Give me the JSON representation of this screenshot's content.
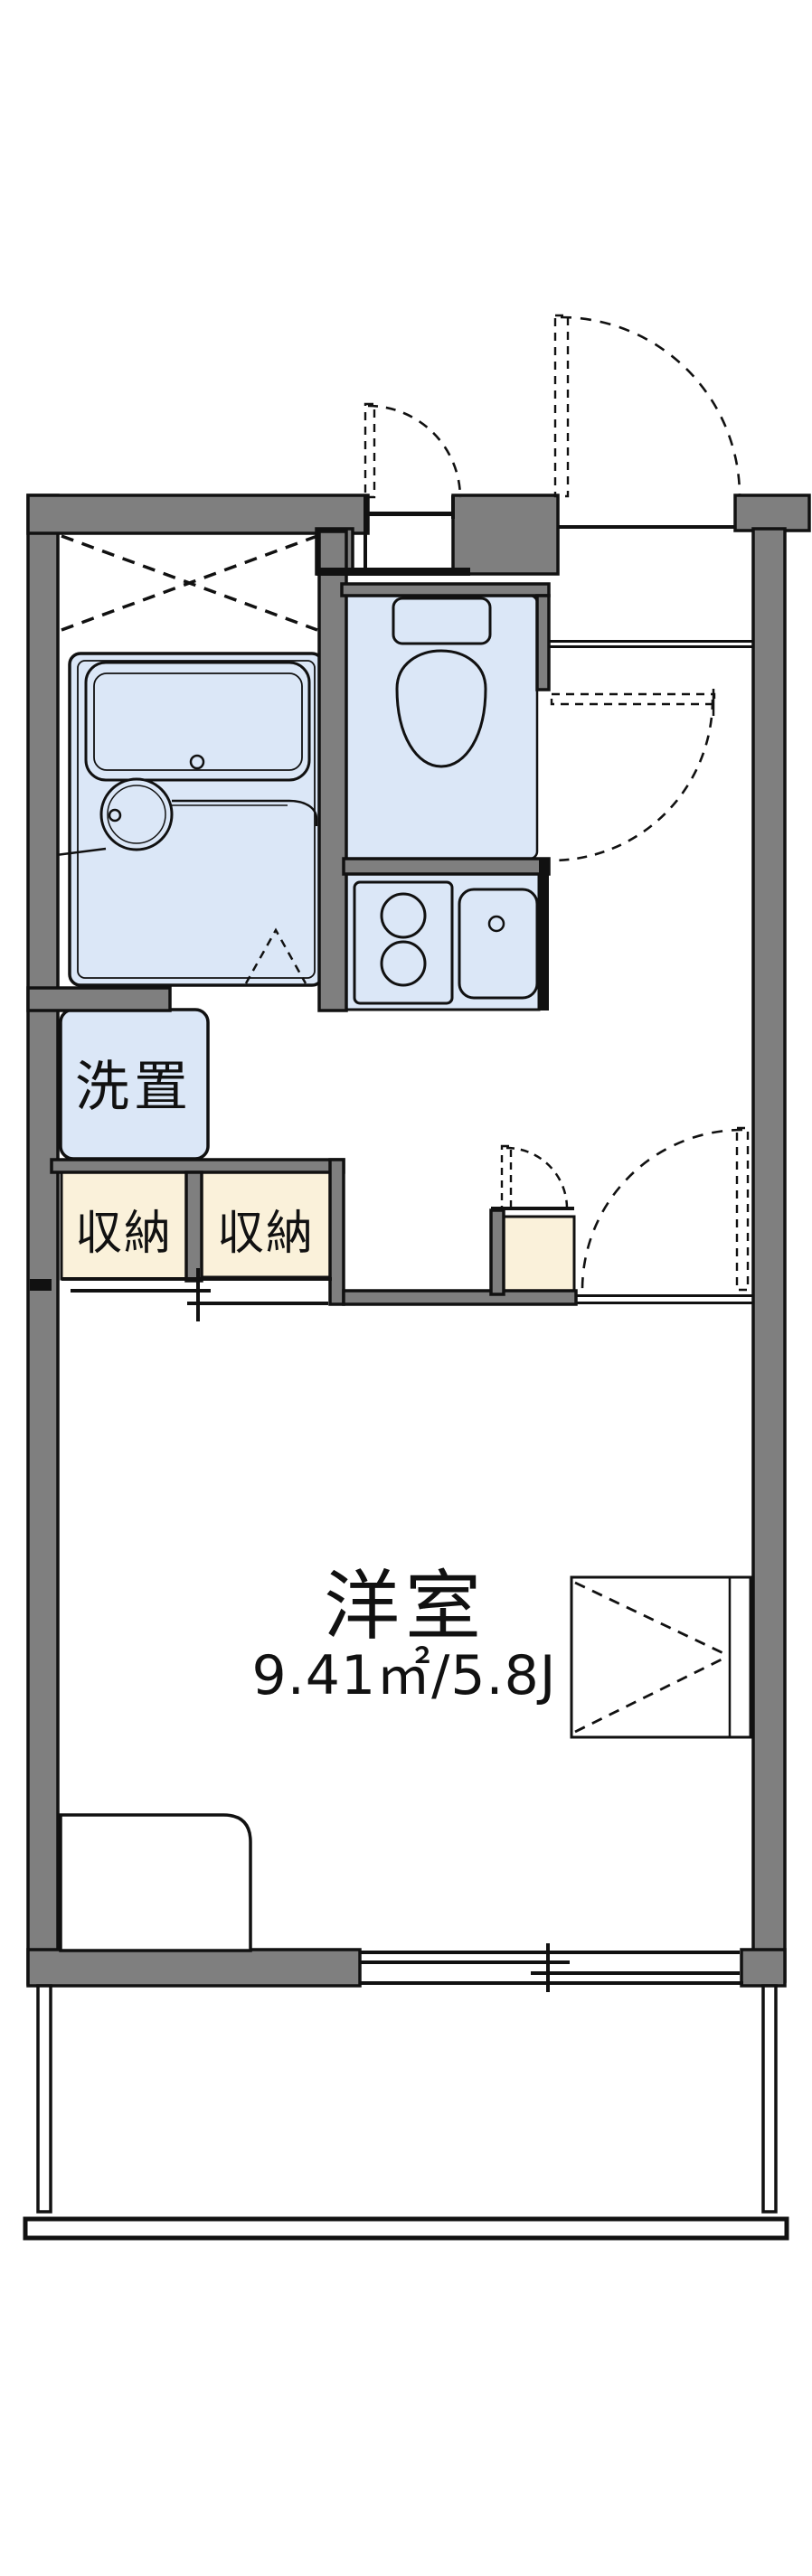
{
  "labels": {
    "washer": "洗置",
    "storage_left": "収納",
    "storage_right": "収納",
    "room_name": "洋室",
    "room_area": "9.41㎡/5.8J"
  },
  "colors": {
    "wall_gray": "#7f7f7f",
    "water_blue": "#dbe7f7",
    "storage_cream": "#faf1da",
    "line_black": "#111111",
    "background": "#ffffff"
  }
}
